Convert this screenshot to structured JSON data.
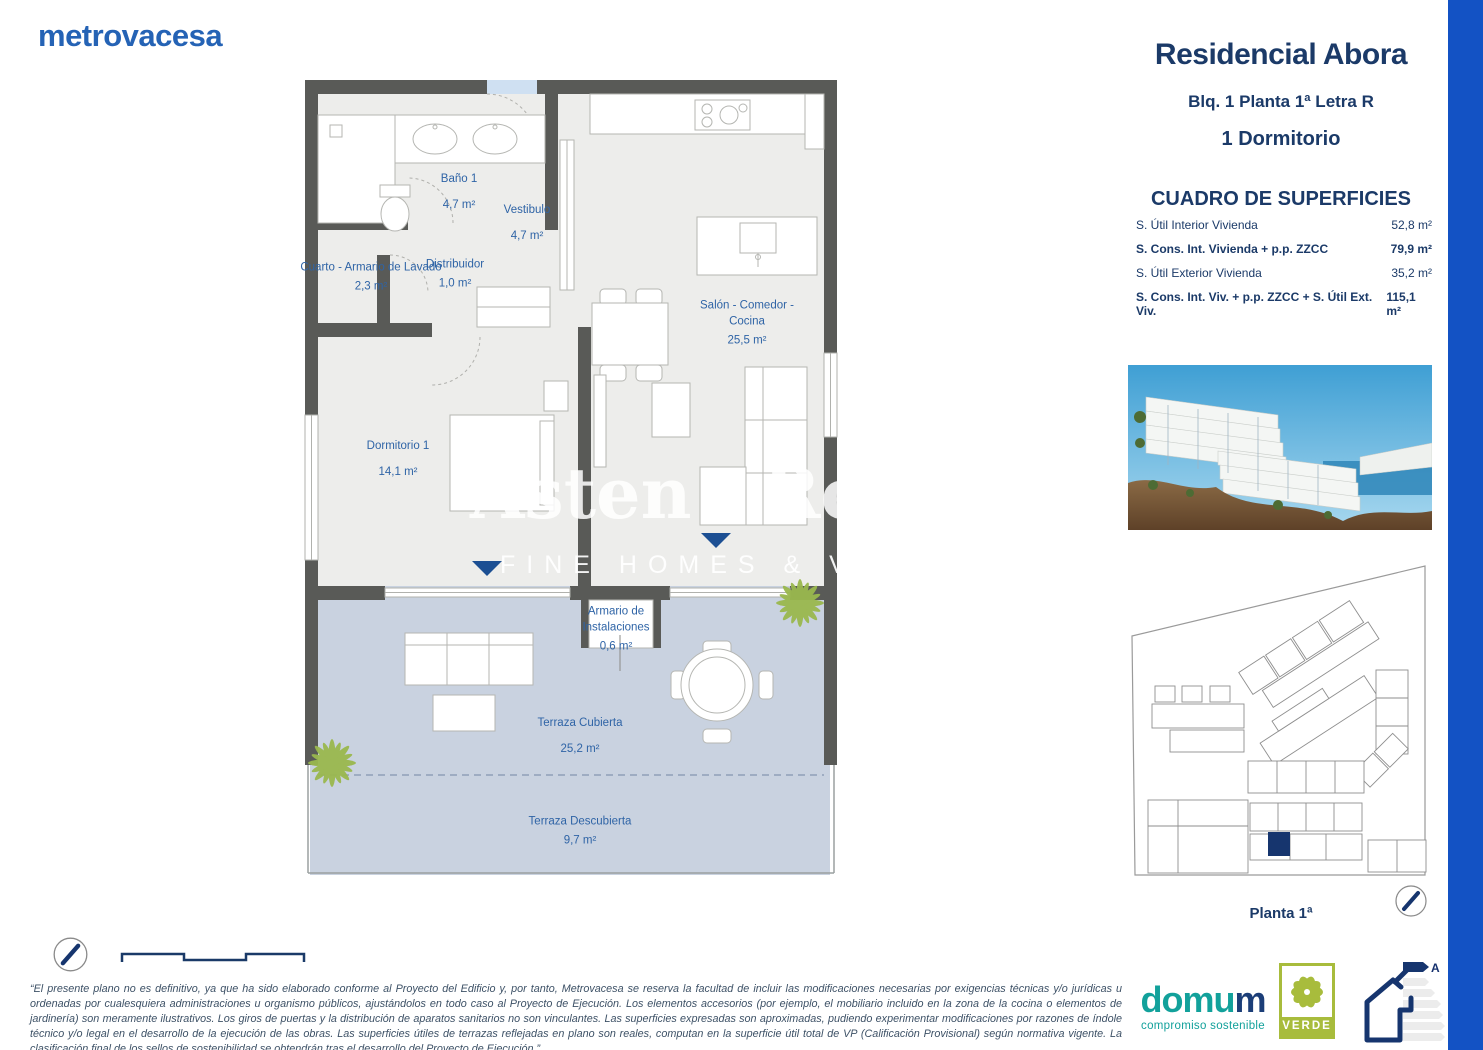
{
  "brand": {
    "logo_text": "metrovacesa"
  },
  "panel": {
    "title": "Residencial Abora",
    "subtitle": "Blq. 1 Planta 1ª Letra R",
    "bedrooms": "1 Dormitorio",
    "surfaces_title": "CUADRO DE SUPERFICIES",
    "surfaces": [
      {
        "label": "S. Útil Interior Vivienda",
        "value": "52,8 m²"
      },
      {
        "label": "S. Cons. Int. Vivienda + p.p. ZZCC",
        "value": "79,9 m²"
      },
      {
        "label": "S. Útil Exterior Vivienda",
        "value": "35,2 m²"
      },
      {
        "label": "S. Cons. Int. Viv. + p.p. ZZCC + S. Útil Ext. Viv.",
        "value": "115,1 m²"
      }
    ],
    "siteplan_caption": "Planta 1ª"
  },
  "floorplan": {
    "rooms": [
      {
        "name": "Baño 1",
        "area": "4,7 m²"
      },
      {
        "name": "Vestibulo",
        "area": "4,7 m²"
      },
      {
        "name": "Cuarto - Armario de Lavado",
        "area": "2,3 m²"
      },
      {
        "name": "Distribuidor",
        "area": "1,0 m²"
      },
      {
        "name": "Salón - Comedor - Cocina",
        "area": "25,5 m²"
      },
      {
        "name": "Dormitorio 1",
        "area": "14,1 m²"
      },
      {
        "name": "Armario de Instalaciones",
        "area": "0,6 m²"
      },
      {
        "name": "Terraza Cubierta",
        "area": "25,2 m²"
      },
      {
        "name": "Terraza Descubierta",
        "area": "9,7 m²"
      }
    ]
  },
  "watermark": {
    "name_left": "Asten",
    "name_right": "Realty",
    "tagline": "FINE HOMES & VILLAS"
  },
  "footer": {
    "disclaimer": "“El presente plano no es definitivo, ya que ha sido elaborado conforme al Proyecto del Edificio y, por tanto, Metrovacesa se reserva la facultad de incluir las modificaciones necesarias por exigencias técnicas y/o jurídicas u ordenadas por cualesquiera administraciones u organismo públicos, ajustándolos en todo caso al Proyecto de Ejecución. Los elementos accesorios (por ejemplo, el mobiliario incluido en la zona de la cocina o elementos de jardinería) son meramente ilustrativos. Los giros de puertas y la distribución de aparatos sanitarios no son vinculantes. Las superficies expresadas son aproximadas, pudiendo experimentar modificaciones por razones de índole técnico y/o legal en el desarrollo de la ejecución de las obras. Las superficies útiles de terrazas reflejadas en plano son reales, computan en la superficie útil total de VP (Calificación Provisional) según normativa vigente. La clasificación final de los sellos de sostenibilidad se obtendrán tras el desarrollo del Proyecto de Ejecución.”"
  },
  "logos": {
    "domum": {
      "part1": "domu",
      "part2": "m",
      "tagline": "compromiso sostenible"
    },
    "verde": {
      "label": "VERDE"
    },
    "energy": {
      "rating": "A"
    }
  },
  "colors": {
    "brand_blue": "#2563b5",
    "navy": "#1b3a68",
    "accent_bar": "#1352c4",
    "plan_label_blue": "#2f64a6",
    "wall_gray": "#595a57",
    "terrace_blue": "#c9d2e0",
    "plant_green": "#9ab84e",
    "domum_teal": "#12a19b",
    "verde_green": "#a8bc3c"
  }
}
